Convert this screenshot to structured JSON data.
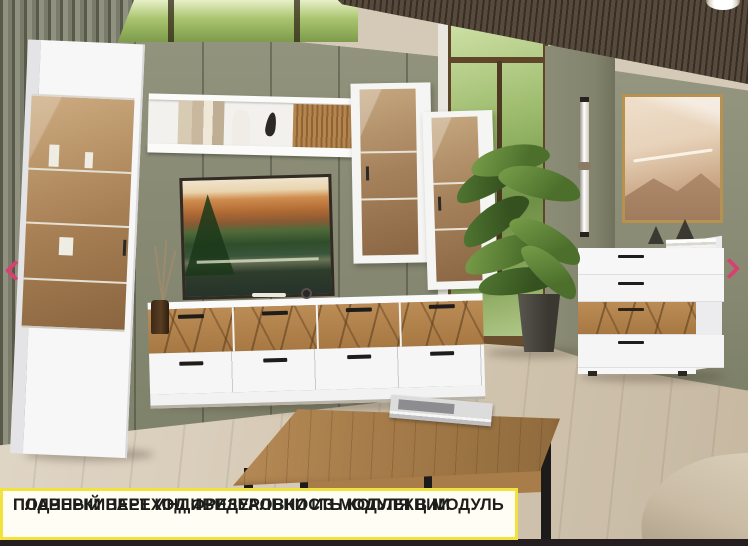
{
  "caption": {
    "line1": "ПЛАВНЫЙ ПЕРЕХОД ФРЕЗЕРОВКИ ИЗ МОДУЛЯ В МОДУЛЬ",
    "line2": "ПОДЧЕРКИВАЕТ ИНДИВИДУАЛЬНОСТЬ КОЛЛЕКЦИИ"
  },
  "carousel": {
    "prev_icon": "chevron-left-icon",
    "next_icon": "chevron-right-icon"
  },
  "palette": {
    "accent_pink": "#d84070",
    "caption_border": "#f2e33c",
    "caption_bg": "#fffdf4",
    "caption_text": "#1d1d1b",
    "wall_green": "#8a8c78",
    "wood_oak": "#b0834e",
    "furniture_white": "#f7f7f7",
    "floor": "#d5c9b8",
    "ceiling_wood": "#4a4136",
    "sofa_beige": "#cfc2ad"
  }
}
